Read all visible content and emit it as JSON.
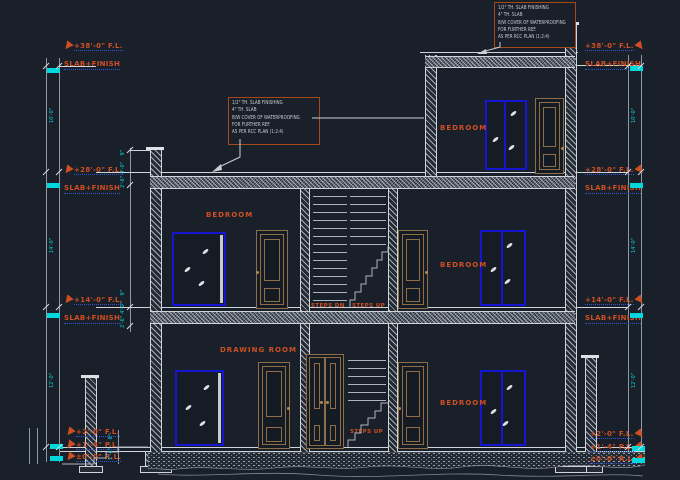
{
  "colors": {
    "background": "#1a202a",
    "line_gray": "#8f97a2",
    "line_bright": "#cfd4da",
    "annotation_orange": "#cf4f22",
    "dimension_cyan": "#00d8dc",
    "window_blue": "#1616d2",
    "door_brown": "#8e6e45",
    "underline_blue": "#2e55d4"
  },
  "levels": {
    "left": [
      {
        "fl": "+38'-0\" F.L.",
        "slab": "SLAB+FINISH"
      },
      {
        "fl": "+28'-0\" F.L.",
        "slab": "SLAB+FINISH"
      },
      {
        "fl": "+14'-0\" F.L.",
        "slab": "SLAB+FINISH"
      }
    ],
    "right": [
      {
        "fl": "+38'-0\" F.L.",
        "slab": "SLAB+FINISH"
      },
      {
        "fl": "+28'-0\" F.L.",
        "slab": "SLAB+FINISH"
      },
      {
        "fl": "+14'-0\" F.L.",
        "slab": "SLAB+FINISH"
      }
    ]
  },
  "plinth": {
    "left": [
      "+2'-0\" F.L.",
      "+1'-4\" P.L.",
      "±0'-0\" R.L."
    ],
    "right": [
      "+2'-0\" F.L.",
      "+1'-4\" P.L.",
      "±0'-0\" R.L."
    ]
  },
  "rooms": {
    "bedroom_top": "BEDROOM",
    "bedroom_mid": "BEDROOM",
    "bedroom_mid_right": "BEDROOM",
    "drawing_room": "DRAWING ROOM",
    "bedroom_ground_right": "BEDROOM"
  },
  "stairs": {
    "steps_dn": "STEPS DN",
    "steps_up_mid": "STEPS UP",
    "steps_up_ground": "STEPS UP"
  },
  "note_box": {
    "lines": [
      "1/2\" TH. SLAB FINISHING",
      "4\" TH. SLAB",
      "B/W COVER OF WATERPROOFING",
      "FOR FURTHER REF.",
      "AS PER RCC PLAN (1:2:4)"
    ]
  },
  "dimensions": {
    "outer_chain": [
      "10'-0\"",
      "14'-0\"",
      "12'-0\""
    ],
    "inner_upper": [
      "9\"",
      "4'-0\"",
      "2'-6\""
    ],
    "inner_lower": [
      "9\"",
      "4'-0\"",
      "2'-6\""
    ],
    "plinth_dims": [
      "8\"",
      "1'-4\""
    ]
  }
}
